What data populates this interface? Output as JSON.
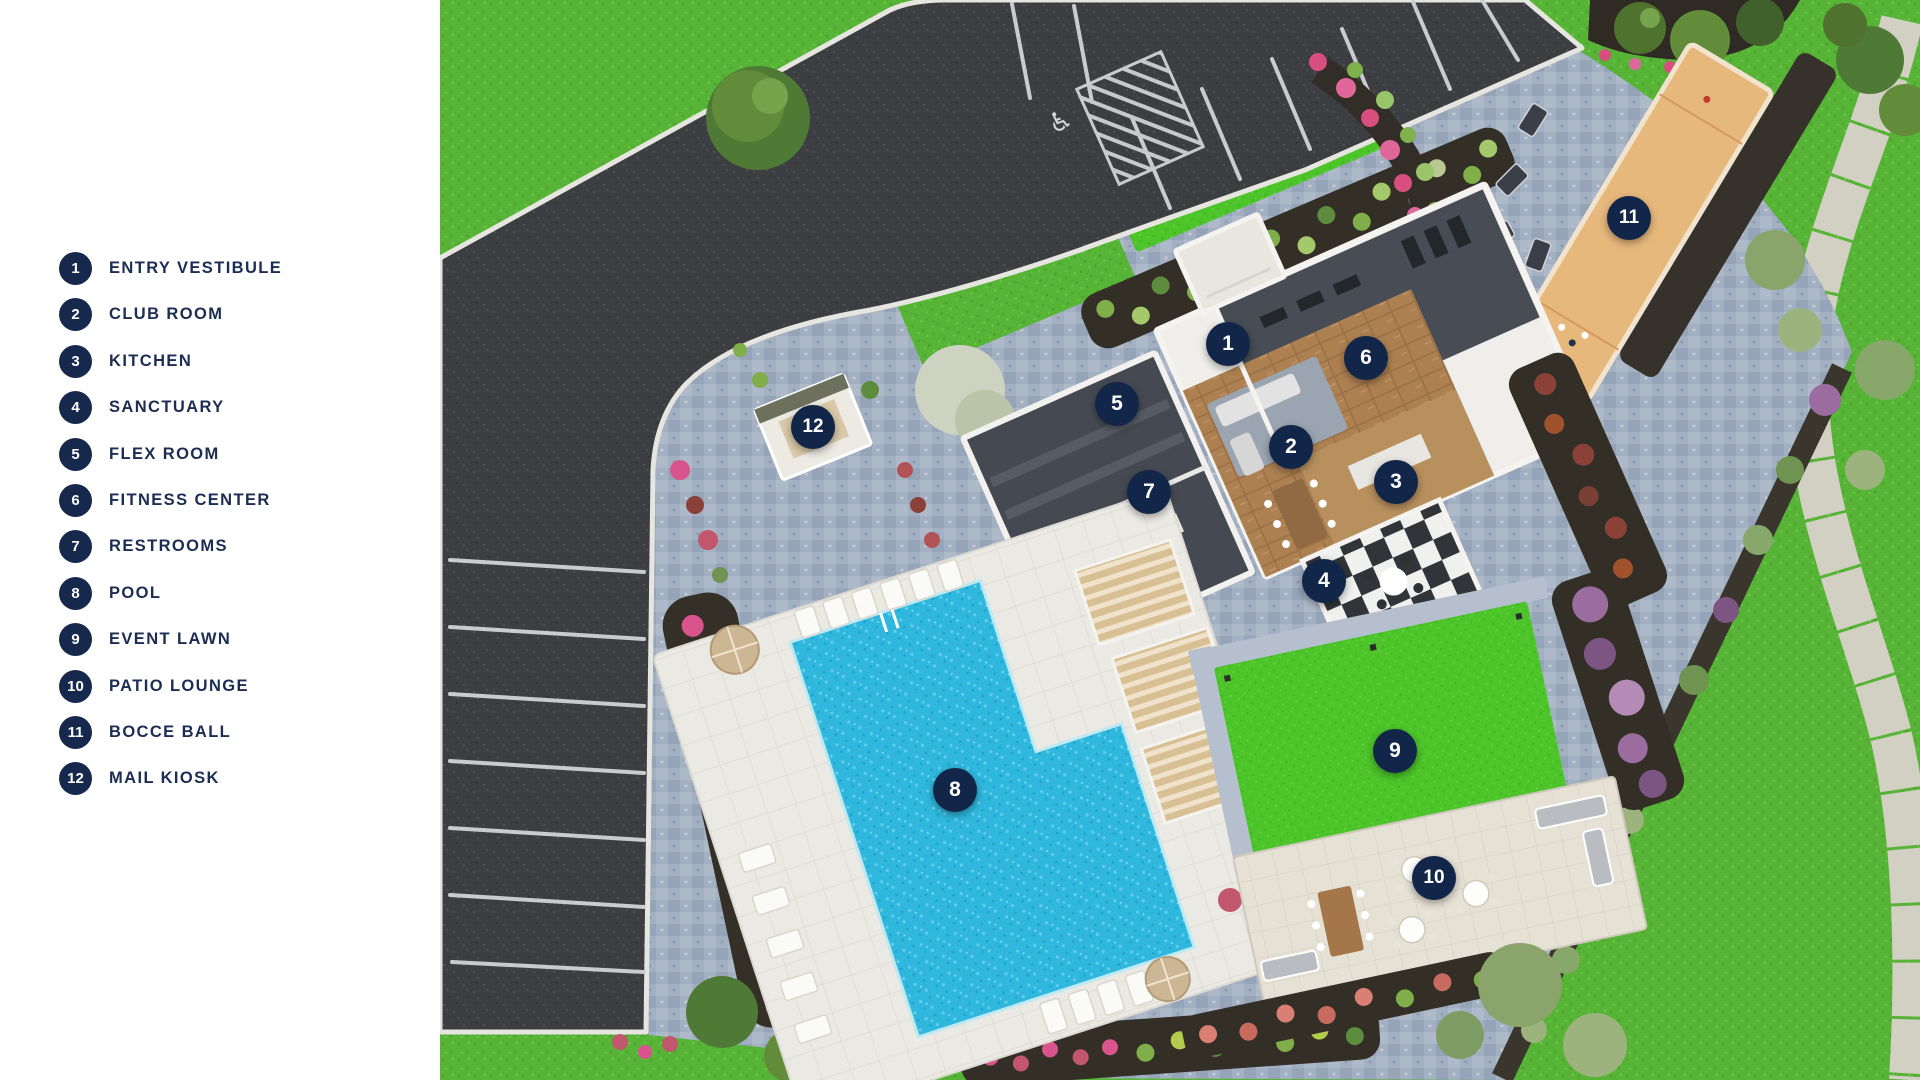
{
  "legend": {
    "items": [
      {
        "number": "1",
        "label": "ENTRY VESTIBULE"
      },
      {
        "number": "2",
        "label": "CLUB ROOM"
      },
      {
        "number": "3",
        "label": "KITCHEN"
      },
      {
        "number": "4",
        "label": "SANCTUARY"
      },
      {
        "number": "5",
        "label": "FLEX ROOM"
      },
      {
        "number": "6",
        "label": "FITNESS CENTER"
      },
      {
        "number": "7",
        "label": "RESTROOMS"
      },
      {
        "number": "8",
        "label": "POOL"
      },
      {
        "number": "9",
        "label": "EVENT LAWN"
      },
      {
        "number": "10",
        "label": "PATIO LOUNGE"
      },
      {
        "number": "11",
        "label": "BOCCE BALL"
      },
      {
        "number": "12",
        "label": "MAIL KIOSK"
      }
    ]
  },
  "map": {
    "markers": [
      {
        "number": "1",
        "label": "ENTRY VESTIBULE",
        "x": 788,
        "y": 344
      },
      {
        "number": "2",
        "label": "CLUB ROOM",
        "x": 851,
        "y": 447
      },
      {
        "number": "3",
        "label": "KITCHEN",
        "x": 956,
        "y": 482
      },
      {
        "number": "4",
        "label": "SANCTUARY",
        "x": 884,
        "y": 581
      },
      {
        "number": "5",
        "label": "FLEX ROOM",
        "x": 677,
        "y": 404
      },
      {
        "number": "6",
        "label": "FITNESS CENTER",
        "x": 926,
        "y": 358
      },
      {
        "number": "7",
        "label": "RESTROOMS",
        "x": 709,
        "y": 492
      },
      {
        "number": "8",
        "label": "POOL",
        "x": 515,
        "y": 790
      },
      {
        "number": "9",
        "label": "EVENT LAWN",
        "x": 955,
        "y": 751
      },
      {
        "number": "10",
        "label": "PATIO LOUNGE",
        "x": 994,
        "y": 878
      },
      {
        "number": "11",
        "label": "BOCCE BALL",
        "x": 1189,
        "y": 218
      },
      {
        "number": "12",
        "label": "MAIL KIOSK",
        "x": 373,
        "y": 427
      }
    ],
    "accessible_parking_symbol": "♿",
    "colors": {
      "navy": "#16294d",
      "marker_navy": "#122649",
      "grass": "#57b437",
      "event_lawn": "#4cc42a",
      "asphalt": "#3c3e42",
      "pavers": "#a3b0c2",
      "pool_water": "#2fb7dd",
      "pool_deck": "#ebe9e3",
      "bocce_court": "#e7b87c",
      "walking_path": "#d2cfc3"
    }
  }
}
